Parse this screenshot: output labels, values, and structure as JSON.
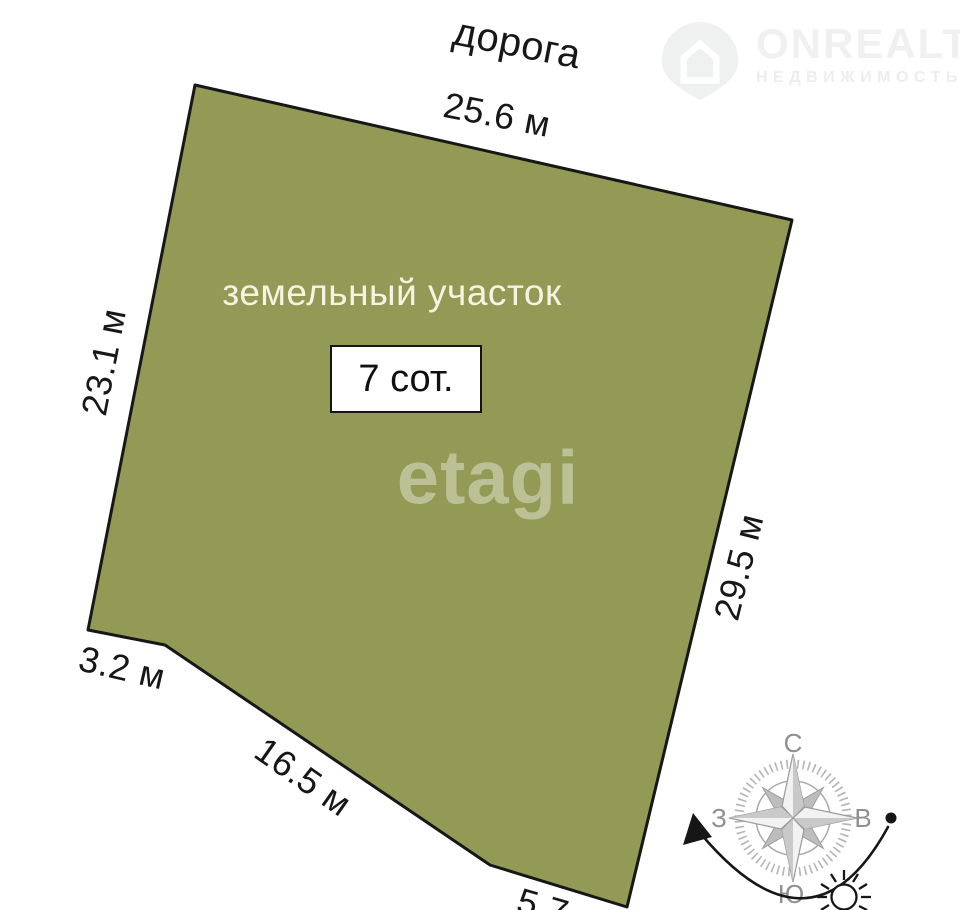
{
  "brand": {
    "name": "ONREALT",
    "tagline": "НЕДВИЖИМОСТЬ"
  },
  "road_label": "дорога",
  "parcel": {
    "label": "земельный участок",
    "area": "7 сот.",
    "watermark": "etagi",
    "fill": "#929a55",
    "outline": "#171717"
  },
  "dimensions": {
    "top": "25.6 м",
    "left": "23.1 м",
    "right": "29.5 м",
    "notch": "3.2 м",
    "bottom_left": "16.5 м",
    "bottom": "5.7 м"
  },
  "compass": {
    "north": "С",
    "south": "Ю",
    "west": "З",
    "east": "В"
  }
}
